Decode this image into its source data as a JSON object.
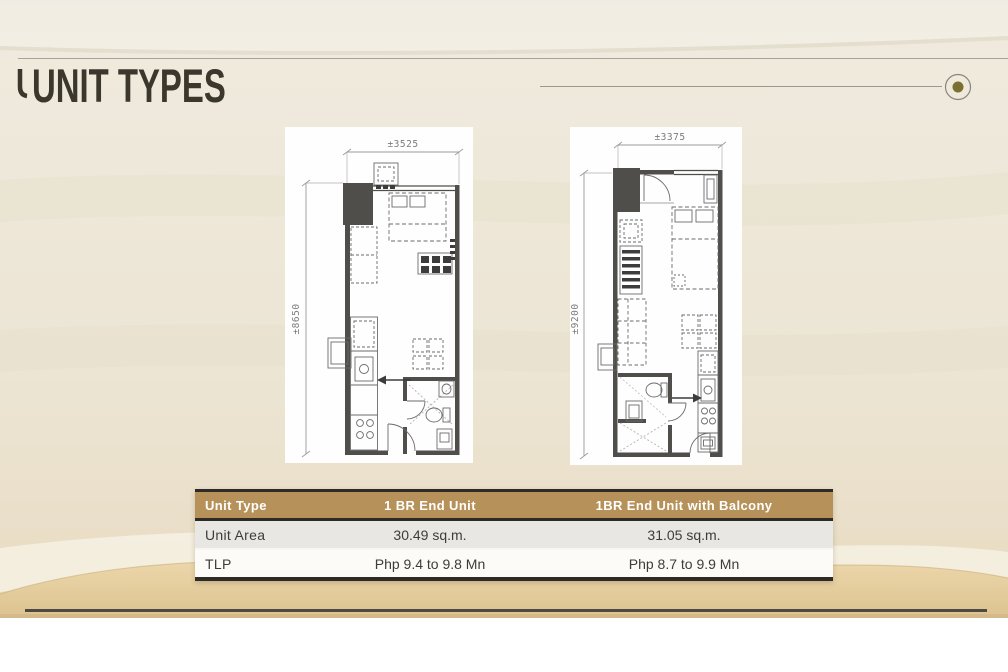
{
  "slide": {
    "title": "UNIT TYPES"
  },
  "decor": {
    "corner_dot_color": "#7c7031",
    "accent_gold": "#b6915a"
  },
  "floorplans": [
    {
      "id": "plan-a",
      "width_dim": "±3525",
      "height_dim": "±8650"
    },
    {
      "id": "plan-b",
      "width_dim": "±3375",
      "height_dim": "±9200"
    }
  ],
  "table": {
    "columns": [
      "Unit Type",
      "1 BR End Unit",
      "1BR End Unit with Balcony"
    ],
    "rows": [
      {
        "label": "Unit Area",
        "values": [
          "30.49 sq.m.",
          "31.05 sq.m."
        ]
      },
      {
        "label": "TLP",
        "values": [
          "Php 9.4 to 9.8 Mn",
          "Php 8.7 to 9.9 Mn"
        ]
      }
    ]
  }
}
